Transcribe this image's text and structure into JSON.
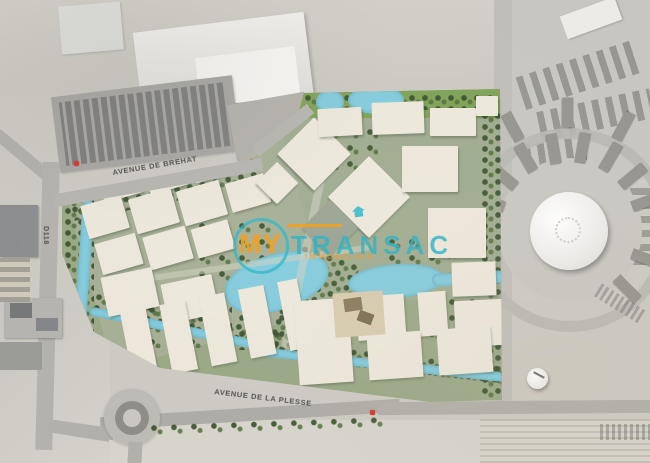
{
  "labels": {
    "avenue_top": "AVENUE DE BREHAT",
    "avenue_bottom": "AVENUE DE LA PLESSE",
    "road_left": "D118"
  },
  "watermark": {
    "brand_prefix": "MY",
    "brand_suffix": "TRANSAC",
    "tagline": "IMMOBILIER"
  },
  "colors": {
    "accent_orange": "#f39c12",
    "accent_teal": "#2ab5c8",
    "water": "#84cbdc",
    "building_cream": "#ece7da",
    "landscape_green": "#7d9b5f",
    "marker_red": "#cf3b2e"
  }
}
